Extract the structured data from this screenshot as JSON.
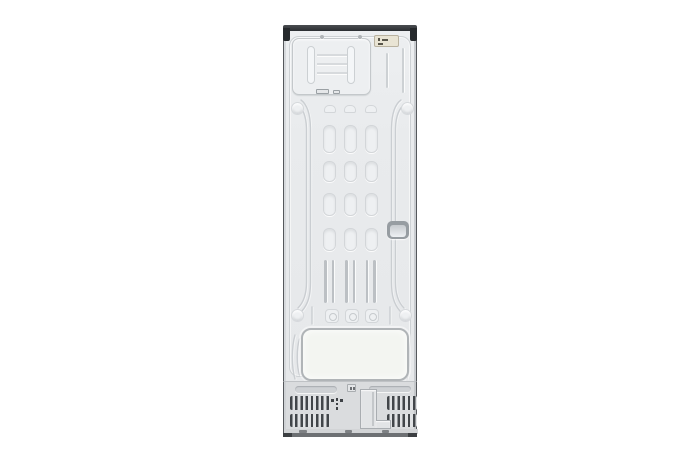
{
  "page": {
    "background": "#ffffff",
    "kind": "product-gallery-photo"
  },
  "product_image": {
    "alt": "Rear view of a tall single-door refrigerator: metal back panel with embossed stiffening vents, upper evaporator service cover, specification sticker, recessed grip, lower compressor cover panel and bottom ventilation grille",
    "parts": {
      "top_cap": "Top edge cap",
      "hinge_brackets": "Corner hinge brackets",
      "evaporator_cover": "Upper recessed service panel",
      "spec_label": "Specification sticker",
      "emboss_grid": "Embossed stiffening vents",
      "handle_recess": "Recessed grip",
      "vent_slits": "Vertical vent slits",
      "compressor_cover": "Lower insulation cover panel",
      "base_grille": "Bottom ventilation grille",
      "drain_cover": "Drain cover plate",
      "ground_mark": "Molded ground marking",
      "bottom_rail": "Bottom rail and feet"
    }
  },
  "colors": {
    "bg": "#ffffff",
    "panel": "#e9ebed",
    "emboss_line": "#cdd1d4",
    "emboss_fill": "#eef0f2",
    "edge_dark": "#55585c",
    "cap_dark": "#34373b",
    "bracket_dark": "#26292c",
    "label_bg": "#e9e4d4",
    "label_border": "#b9b2a0",
    "handle_ring": "#979da2",
    "big_panel_fill": "#f3f5f1",
    "big_panel_border": "#b0b4b7",
    "base_bg": "#dadcde",
    "slat_dark": "#42464a",
    "slat_light": "#e0e2e4",
    "plate_fill": "#e2e4e6",
    "plate_border": "#a9adb1",
    "kick": "#d2d4d6",
    "bottom_bar": "#6d7073",
    "bottom_foot": "#3c3f42"
  }
}
